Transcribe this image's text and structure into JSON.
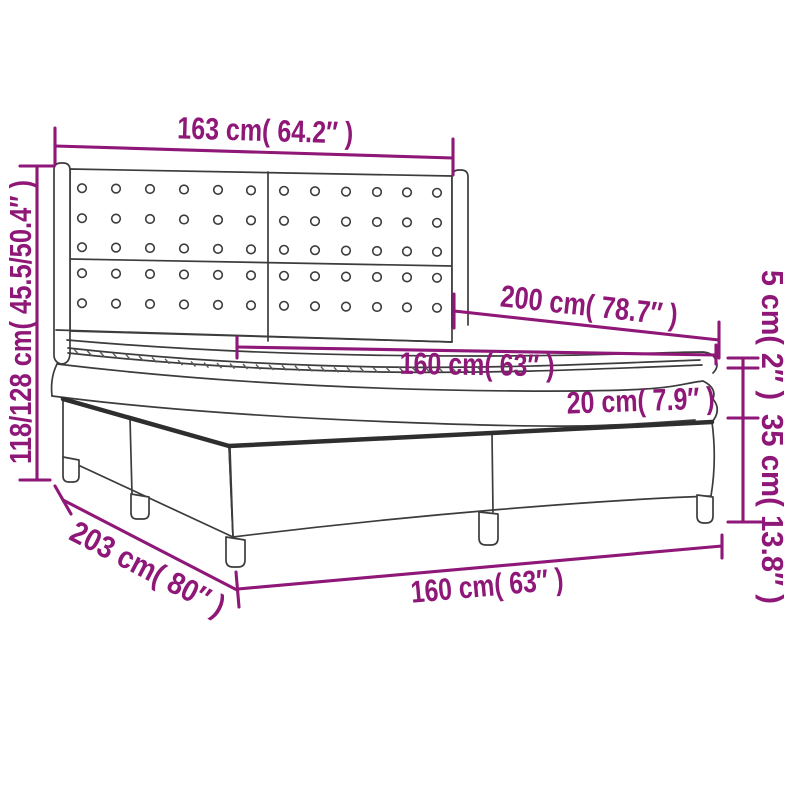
{
  "diagram": {
    "title": "box spring bed with tufted winged headboard - dimension diagram",
    "colors": {
      "dimension_accent": "#8e1778",
      "line_art": "#3c3c3c",
      "background": "#ffffff"
    },
    "labels": {
      "headboard_width": "163 cm( 64.2″ )",
      "total_height": "118/128 cm( 45.5/50.4″ )",
      "mattress_length": "200 cm( 78.7″ )",
      "mattress_width": "160 cm( 63″ )",
      "mattress_thickness": "20 cm( 7.9″ )",
      "topper_thickness": "5 cm( 2″ )",
      "base_height": "35 cm( 13.8″ )",
      "base_length": "203 cm( 80″ )",
      "base_width": "160 cm( 63″ )"
    }
  }
}
